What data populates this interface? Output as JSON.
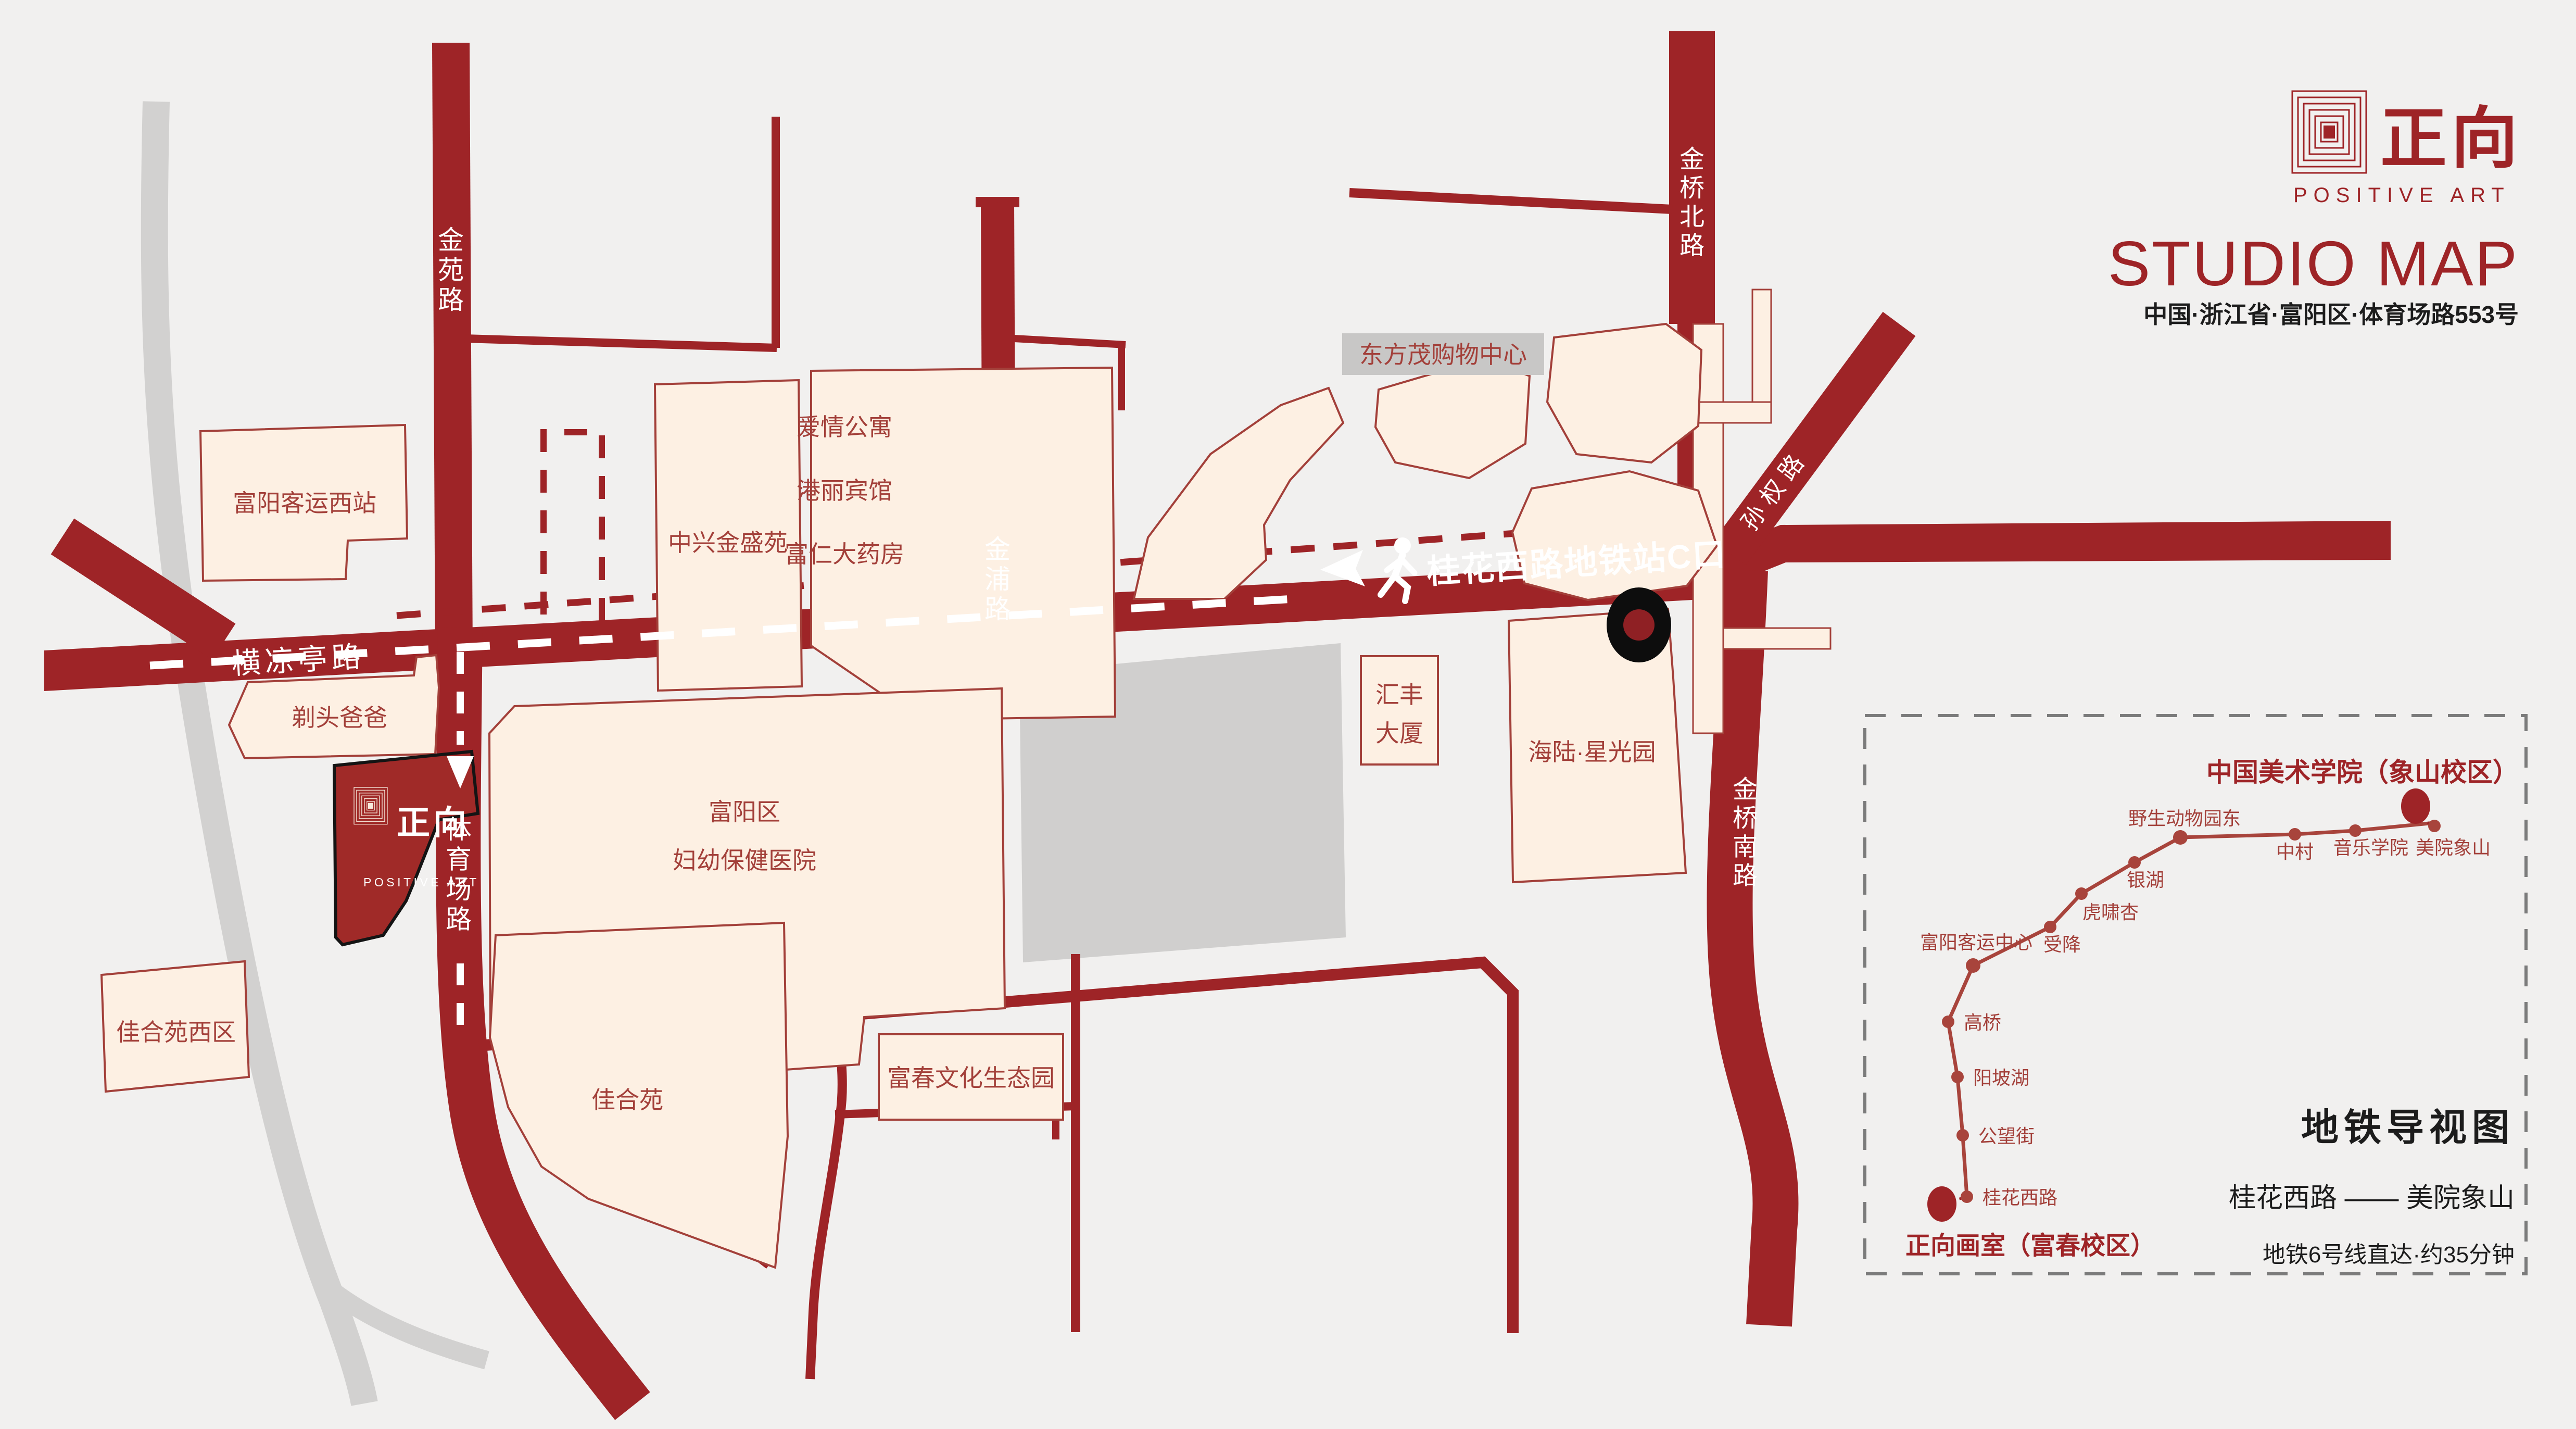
{
  "header": {
    "logo_cn": "正向",
    "logo_en": "POSITIVE ART",
    "title": "STUDIO MAP",
    "address": "中国·浙江省·富阳区·体育场路553号"
  },
  "map": {
    "roads": {
      "jinyuan": "金苑路",
      "jinpu": "金浦路",
      "jinqiao_north": "金桥北路",
      "jinqiao_south": "金桥南路",
      "sunquan": "孙权路",
      "hengliangting": "横凉亭路",
      "tiyuchang": "体育场路"
    },
    "route_label": "桂花西路地铁站C口",
    "buildings": {
      "fuyang_west_station": "富阳客运西站",
      "zhongxing": "中兴金盛苑",
      "aiqing": "爱情公寓",
      "gangli": "港丽宾馆",
      "furen": "富仁大药房",
      "dongfangmao": "东方茂购物中心",
      "huifeng_line1": "汇丰",
      "huifeng_line2": "大厦",
      "hailu": "海陆·星光园",
      "titou": "剃头爸爸",
      "hospital_line1": "富阳区",
      "hospital_line2": "妇幼保健医院",
      "jiaheyuan_west": "佳合苑西区",
      "jiaheyuan": "佳合苑",
      "fuchun_park": "富春文化生态园"
    },
    "studio": {
      "logo_cn": "正向",
      "logo_en": "POSITIVE ART"
    }
  },
  "inset": {
    "title": "地铁导视图",
    "terminal": "中国美术学院（象山校区）",
    "origin": "正向画室（富春校区）",
    "route": "桂花西路 —— 美院象山",
    "info": "地铁6号线直达·约35分钟",
    "stations": [
      "桂花西路",
      "公望街",
      "阳坡湖",
      "高桥",
      "富阳客运中心",
      "受降",
      "虎啸杏",
      "银湖",
      "野生动物园东",
      "中村",
      "音乐学院",
      "美院象山"
    ]
  }
}
